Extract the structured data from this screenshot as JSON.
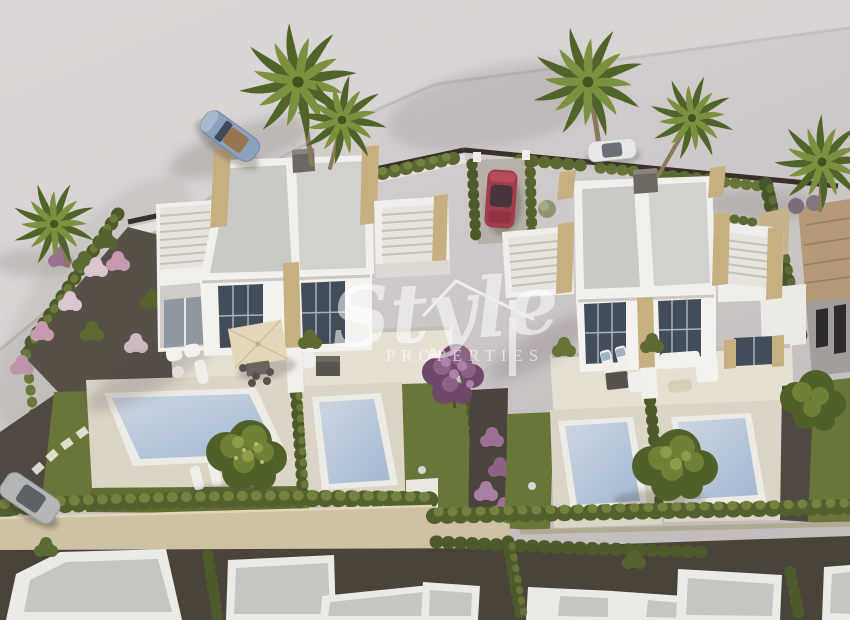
{
  "watermark": {
    "script": "Style",
    "caps": "PROPERTIES",
    "icon": "house-roof-outline",
    "color": "#ffffff"
  },
  "scene": {
    "description": "Aerial 3D architectural render of two white duplex villas with four private pools, sun terraces, gardens, palm trees and parked cars; row of neighbouring white flat-roof houses along the bottom street.",
    "objects": [
      "left-duplex-villa",
      "right-duplex-villa",
      "rooftop-staircases",
      "pool-1",
      "pool-2",
      "pool-3",
      "pool-4",
      "left-terrace-with-umbrella",
      "right-terrace-lounge-set",
      "blue-convertible-car",
      "white-car",
      "red-car",
      "silver-car",
      "palm-trees",
      "garden-trees",
      "purple-bougainvillea",
      "boundary-hedges",
      "stepping-stone-path",
      "neighbour-tiled-roof-house",
      "bottom-houses-row",
      "stone-wall",
      "back-alley"
    ],
    "palette": {
      "street": "#cfc9c8",
      "roof": "#cbcac6",
      "wall_white": "#f3f1ed",
      "window": "#414d59",
      "stone_accent": "#c6b081",
      "deck": "#dcd5c6",
      "terrace": "#e6e0d3",
      "lawn": "#68763a",
      "hedge": "#5b6932",
      "pool_water": "#b6c6da",
      "gravel": "#4f4941",
      "bottom_wall": "#cfc2a4",
      "road": "#494339",
      "purple_flowers": "#9c6f94",
      "car_blue": "#8ba1bd",
      "car_red": "#a23c4b",
      "neighbour_roof": "#b49a76"
    }
  }
}
